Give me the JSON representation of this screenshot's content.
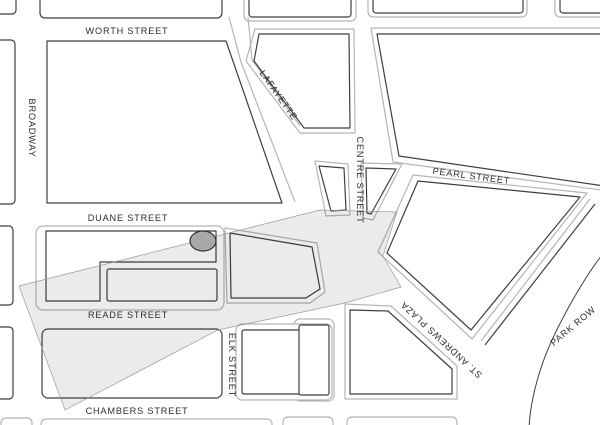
{
  "map": {
    "title": "Foley Square area street map",
    "background_color": "#ffffff",
    "block_line_color": "#3f3f3f",
    "curb_line_color": "#b5b5b5",
    "shade_fill": "rgba(0,0,0,0.08)",
    "shade_stroke": "#9a9a9a",
    "marker": {
      "name": "site-marker-oval",
      "fill": "#a8a8a8",
      "stroke": "#2f2f2f"
    },
    "streets": {
      "worth": {
        "name": "WORTH STREET"
      },
      "broadway": {
        "name": "BROADWAY"
      },
      "lafayette": {
        "name": "LAFAYETTE"
      },
      "duane": {
        "name": "DUANE STREET"
      },
      "reade": {
        "name": "READE STREET"
      },
      "chambers": {
        "name": "CHAMBERS STREET"
      },
      "elk": {
        "name": "ELK STREET"
      },
      "centre": {
        "name": "CENTRE STREET"
      },
      "pearl": {
        "name": "PEARL STREET"
      },
      "standrews": {
        "name": "ST. ANDREWS PLAZA"
      },
      "parkrow": {
        "name": "PARK ROW"
      }
    }
  }
}
